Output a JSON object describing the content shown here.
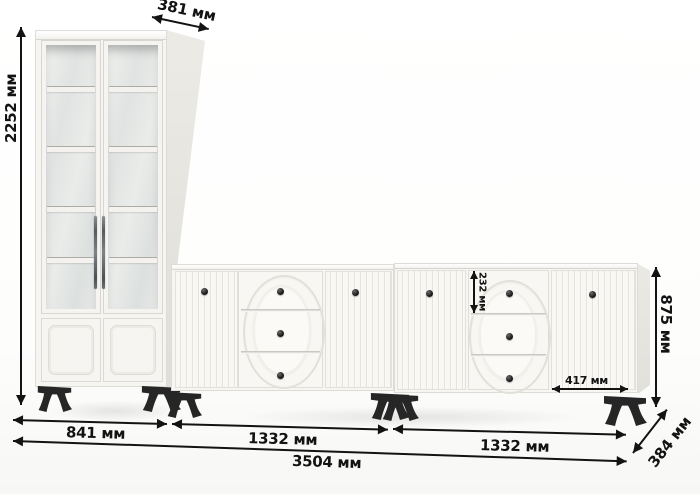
{
  "diagram": {
    "type": "furniture-dimension-diagram",
    "pieces": [
      "glass display cabinet",
      "sideboard with drawers (left)",
      "sideboard with drawers (right)"
    ]
  },
  "labels": {
    "cabinet_depth": "381 мм",
    "cabinet_height": "2252 мм",
    "sideboard_height": "875 мм",
    "top_drawer_height": "232 мм",
    "right_door_width": "417 мм",
    "sideboard_depth": "384 мм",
    "cabinet_width": "841 мм",
    "sideboard1_width": "1332 мм",
    "sideboard2_width": "1332 мм",
    "total_width": "3504 мм"
  },
  "colors": {
    "dimension_ink": "#131313",
    "furniture_white": "#f6f5f1",
    "side_panel": "#e8e6e0",
    "glass": "#e2e5e3",
    "legs_and_knobs": "#232323"
  }
}
